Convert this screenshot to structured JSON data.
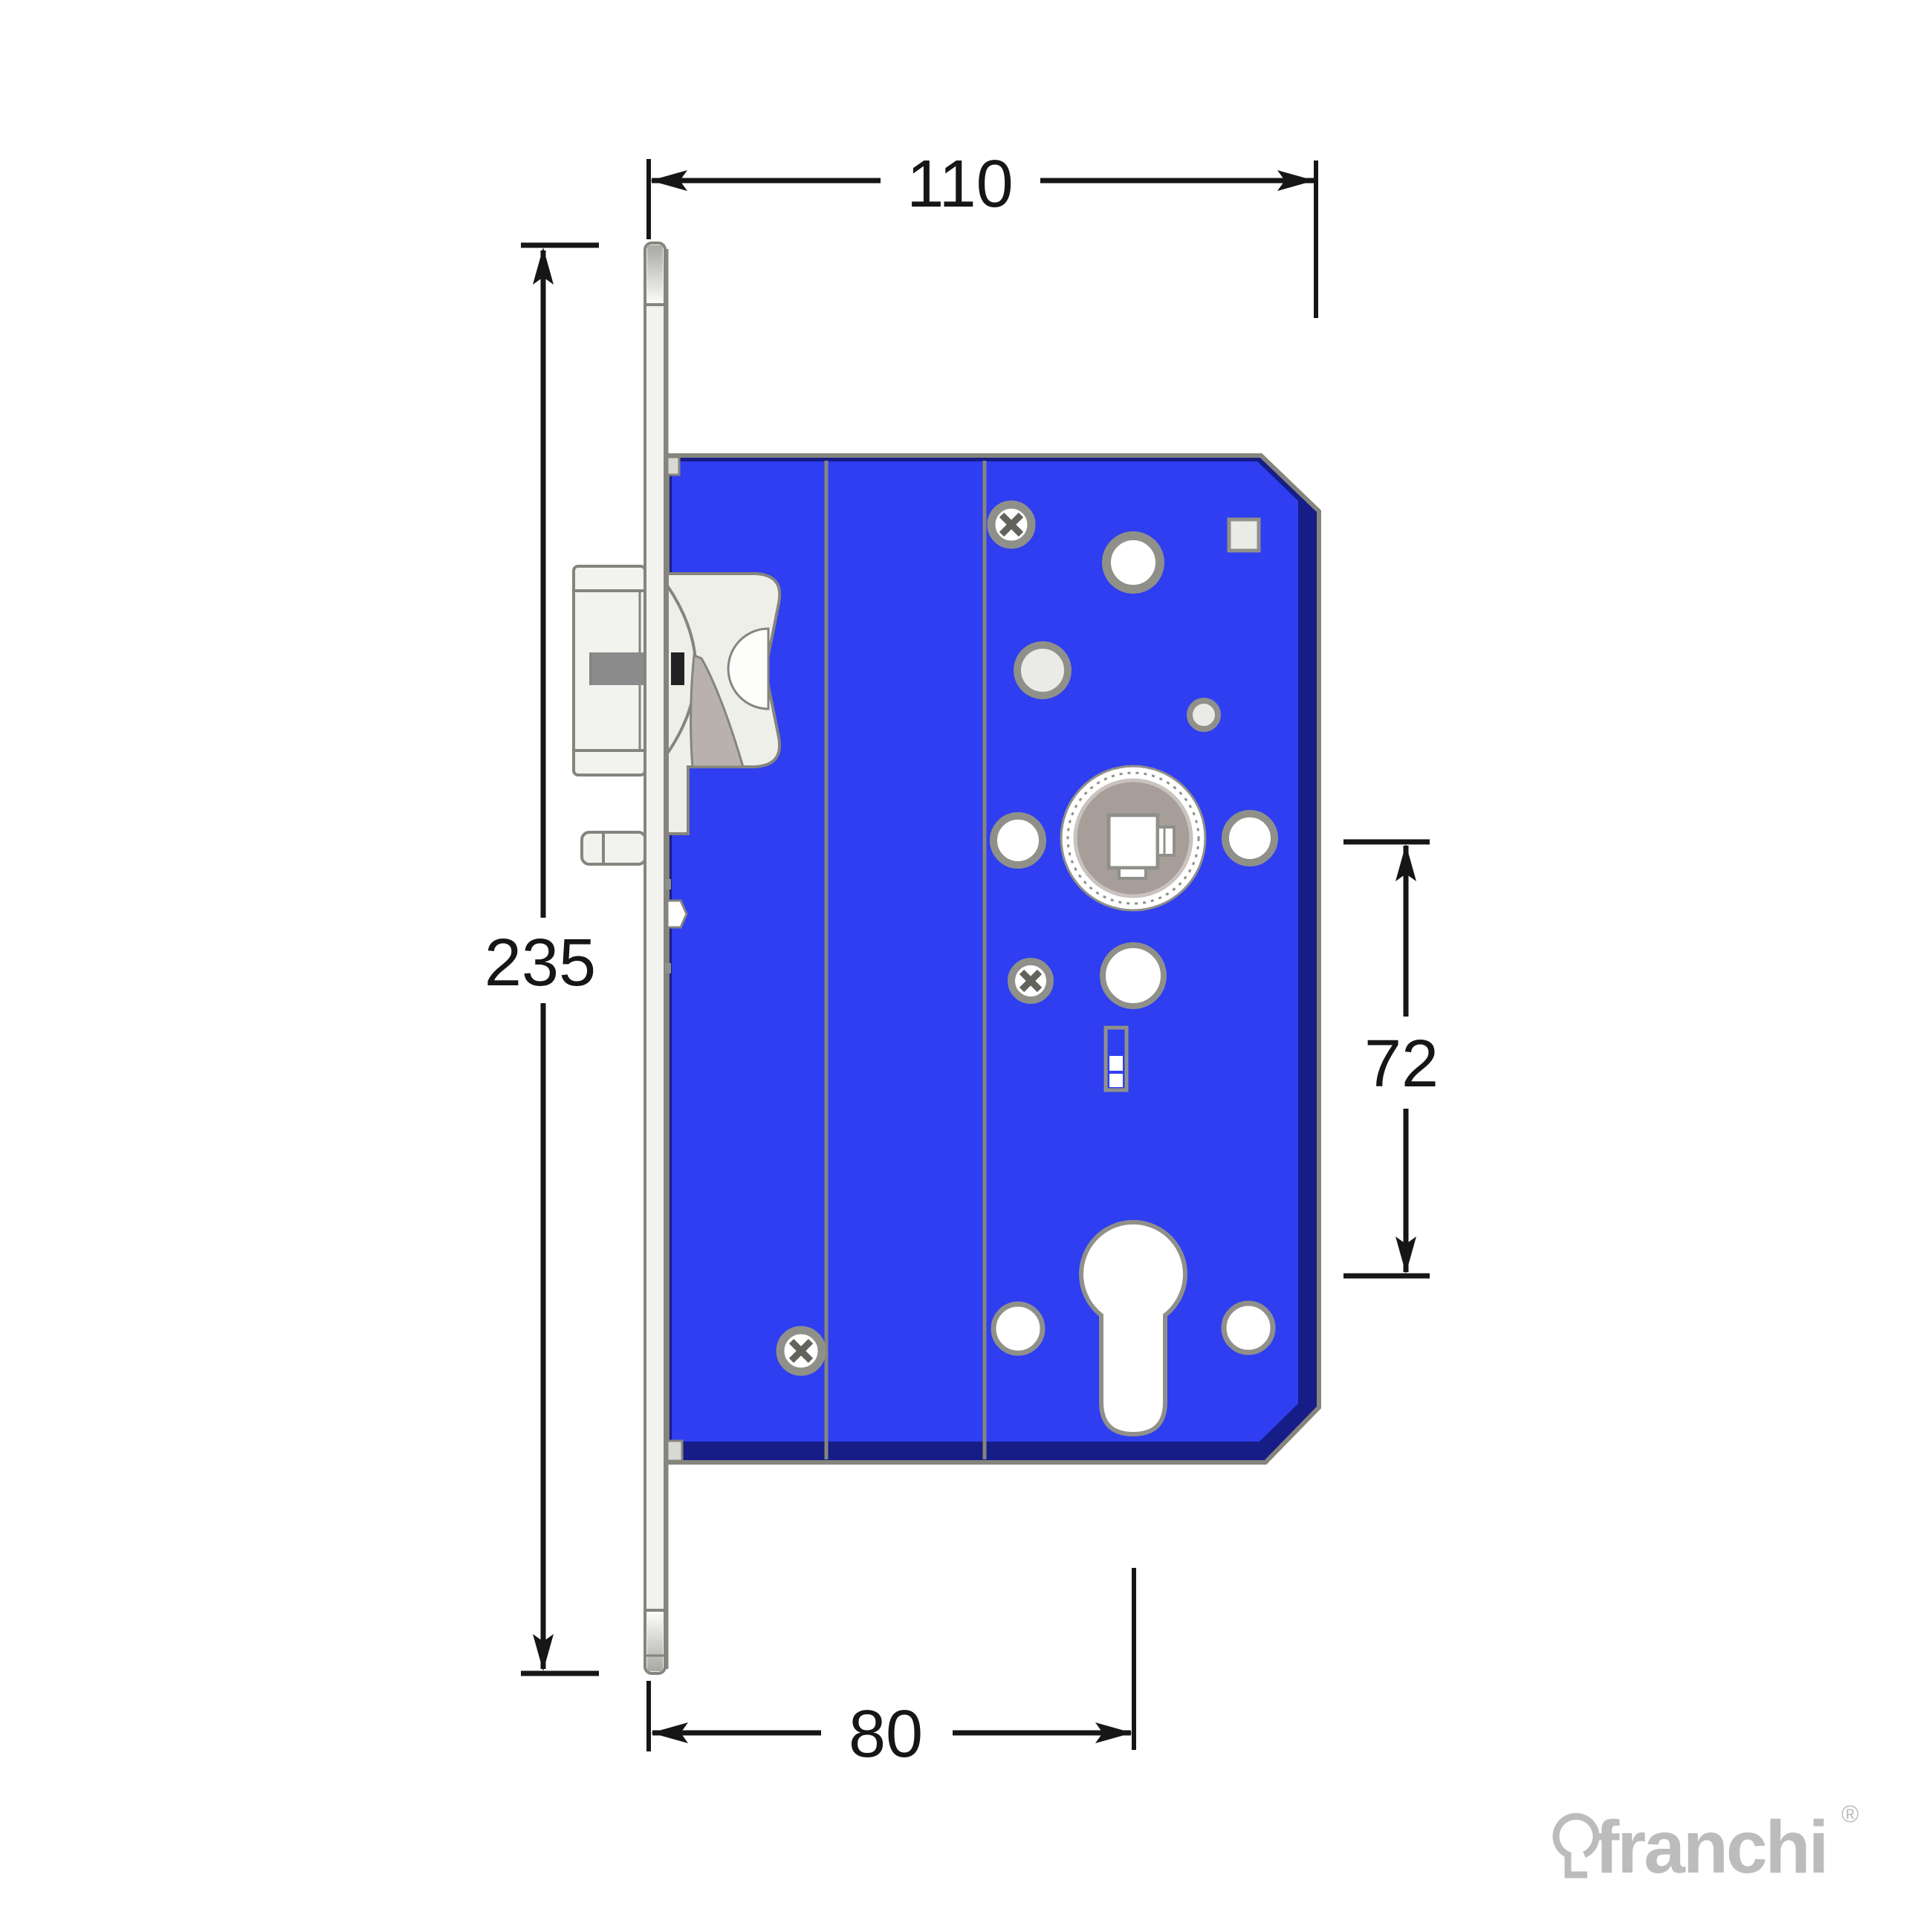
{
  "drawing": {
    "type": "mortise-lock-technical-drawing-side-elevation",
    "dimensions": {
      "overall_width": "110",
      "faceplate_height": "235",
      "hub_to_cylinder_distance": "72",
      "backset": "80"
    },
    "logo": {
      "brand": "franchi",
      "registered_mark": "®"
    },
    "colors": {
      "case-blue": "#2E3EF0",
      "case-navy": "#161D86",
      "outline": "#85857D",
      "metal-white": "#F2F2EE",
      "metal-light": "#EFEFEA",
      "metal-mid": "#D9D9D3",
      "metal-dark": "#8B8B8B",
      "latch-tail": "#B8B1AD",
      "hub-disc": "#A89E99",
      "hub-rim": "#C9C2BE",
      "ring-gray": "#90908A",
      "hole-white": "#FFFFFF",
      "hole-ivory": "#EAEAE6",
      "dim-ink": "#161616",
      "logo-gray": "#BCBCBC"
    }
  }
}
